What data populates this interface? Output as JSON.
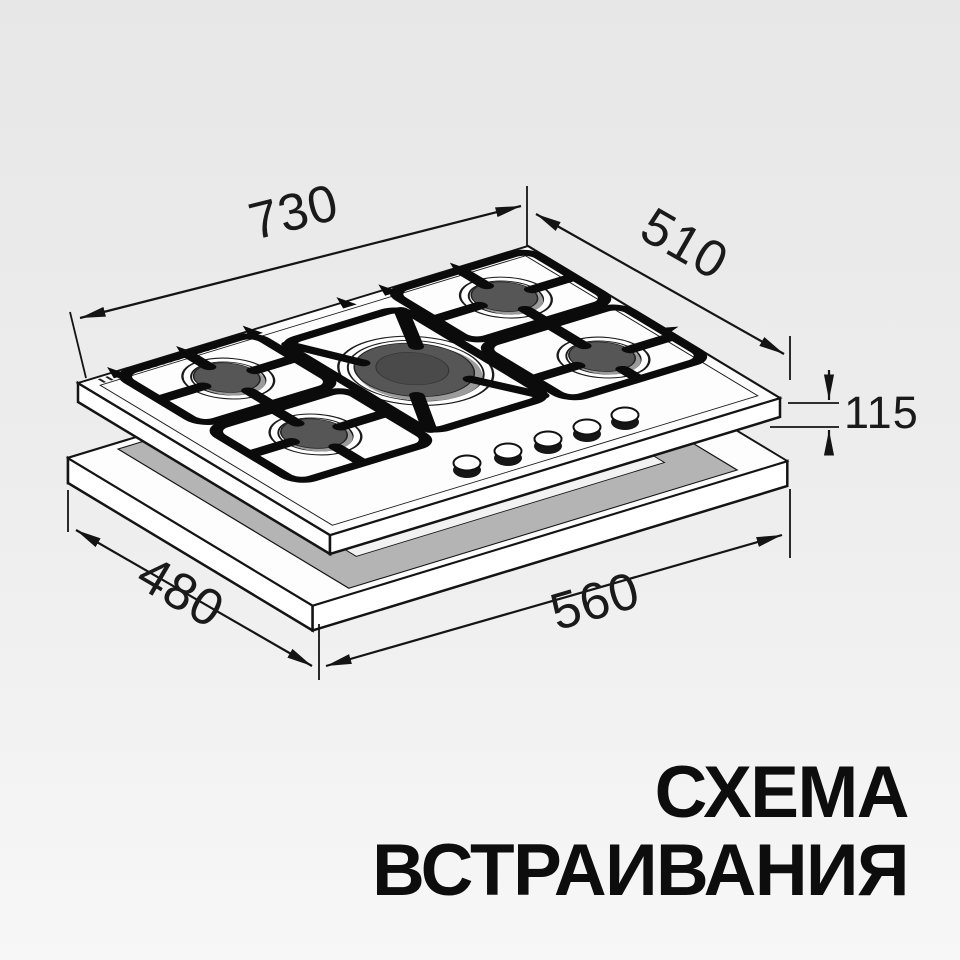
{
  "title": {
    "line1": "СХЕМА",
    "line2": "ВСТРАИВАНИЯ"
  },
  "dimensions": {
    "hob_width_mm": "730",
    "hob_depth_mm": "510",
    "hob_height_mm": "115",
    "cutout_width_mm": "560",
    "cutout_depth_mm": "480"
  },
  "diagram": {
    "burner_count": 5,
    "knob_count": 5,
    "colors": {
      "line": "#141414",
      "burner_cap": "#565656",
      "burner_ring": "#9b9b9b",
      "cutout_wall_gray": "#b4b4b4",
      "background_top": "#e7e7e7",
      "background_bottom": "#f7f7f7"
    }
  }
}
